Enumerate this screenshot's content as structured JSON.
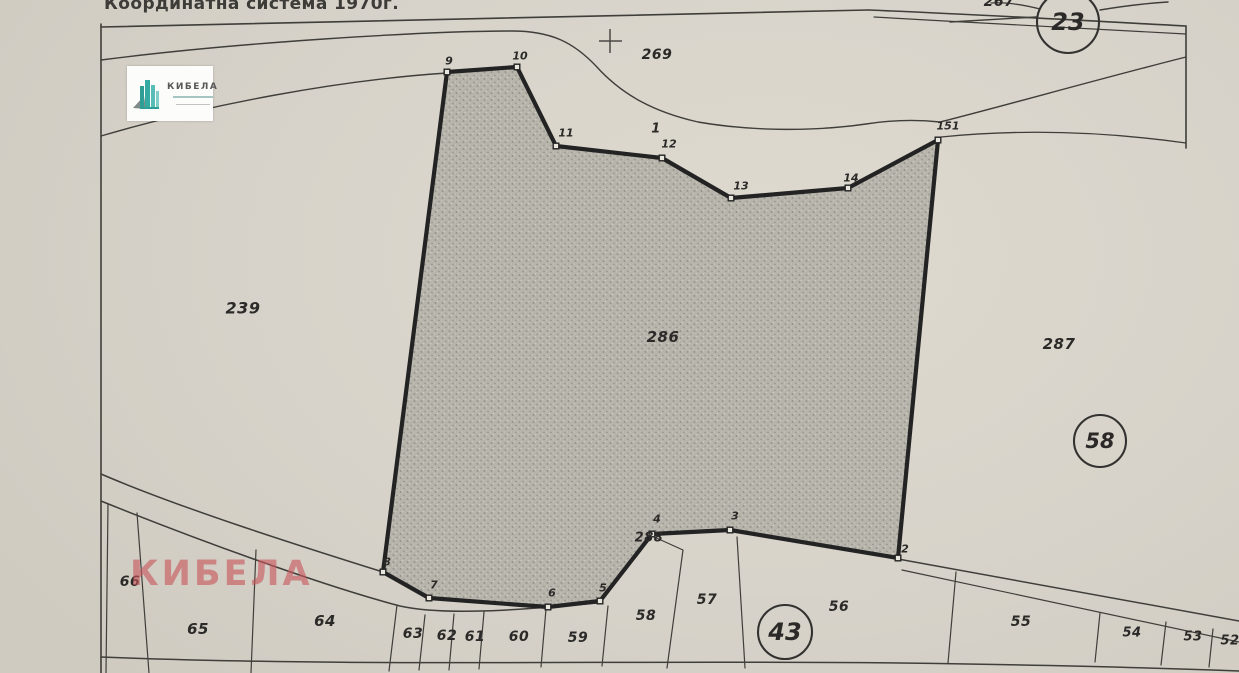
{
  "title": {
    "text": "Координатна система 1970г."
  },
  "logo": {
    "text": "КИБЕЛА"
  },
  "watermark": {
    "text": "КИБЕЛА"
  },
  "map": {
    "colors": {
      "paper": "#d8d4cb",
      "thin_line": "#403e3a",
      "bold_line": "#232323",
      "label": "#2b2a28",
      "vertex_fill": "#e9e6dd",
      "stipple_base": "#b7b4ab",
      "stipple_dark": "#8f8d86",
      "stipple_light": "#cdcac1",
      "circle_stroke": "#333230",
      "watermark_color": "#c9575c",
      "logo_teal": "#35aaa2"
    },
    "main_parcel": {
      "points": [
        [
          447,
          72
        ],
        [
          517,
          67
        ],
        [
          556,
          146
        ],
        [
          662,
          158
        ],
        [
          731,
          198
        ],
        [
          848,
          188
        ],
        [
          938,
          140
        ],
        [
          898,
          558
        ],
        [
          730,
          530
        ],
        [
          652,
          534
        ],
        [
          600,
          601
        ],
        [
          548,
          607
        ],
        [
          429,
          598
        ],
        [
          383,
          572
        ]
      ]
    },
    "vertex_labels": [
      {
        "t": "9",
        "x": 449,
        "y": 61
      },
      {
        "t": "10",
        "x": 520,
        "y": 56
      },
      {
        "t": "11",
        "x": 566,
        "y": 133
      },
      {
        "t": "12",
        "x": 669,
        "y": 144
      },
      {
        "t": "13",
        "x": 741,
        "y": 186
      },
      {
        "t": "14",
        "x": 851,
        "y": 178
      },
      {
        "t": "151",
        "x": 948,
        "y": 126
      },
      {
        "t": "2",
        "x": 905,
        "y": 549
      },
      {
        "t": "3",
        "x": 735,
        "y": 516
      },
      {
        "t": "4",
        "x": 657,
        "y": 519
      },
      {
        "t": "5",
        "x": 603,
        "y": 588
      },
      {
        "t": "6",
        "x": 552,
        "y": 593
      },
      {
        "t": "7",
        "x": 434,
        "y": 585
      },
      {
        "t": "8",
        "x": 387,
        "y": 562
      }
    ],
    "parcel_labels": [
      {
        "t": "239",
        "x": 243,
        "y": 308,
        "s": 16
      },
      {
        "t": "286",
        "x": 663,
        "y": 337,
        "s": 15
      },
      {
        "t": "287",
        "x": 1059,
        "y": 344,
        "s": 15
      },
      {
        "t": "269",
        "x": 657,
        "y": 55,
        "s": 14
      },
      {
        "t": "1",
        "x": 656,
        "y": 129,
        "s": 13
      },
      {
        "t": "288",
        "x": 649,
        "y": 538,
        "s": 13
      },
      {
        "t": "267",
        "x": 999,
        "y": 2,
        "s": 14
      },
      {
        "t": "66",
        "x": 130,
        "y": 582,
        "s": 14
      },
      {
        "t": "65",
        "x": 198,
        "y": 629,
        "s": 15
      },
      {
        "t": "64",
        "x": 325,
        "y": 621,
        "s": 15
      },
      {
        "t": "63",
        "x": 413,
        "y": 634,
        "s": 14
      },
      {
        "t": "62",
        "x": 447,
        "y": 636,
        "s": 14
      },
      {
        "t": "61",
        "x": 475,
        "y": 637,
        "s": 14
      },
      {
        "t": "60",
        "x": 519,
        "y": 637,
        "s": 14
      },
      {
        "t": "59",
        "x": 578,
        "y": 638,
        "s": 14
      },
      {
        "t": "58",
        "x": 646,
        "y": 616,
        "s": 14
      },
      {
        "t": "57",
        "x": 707,
        "y": 600,
        "s": 14
      },
      {
        "t": "56",
        "x": 839,
        "y": 607,
        "s": 14
      },
      {
        "t": "55",
        "x": 1021,
        "y": 622,
        "s": 14
      },
      {
        "t": "54",
        "x": 1132,
        "y": 633,
        "s": 13
      },
      {
        "t": "53",
        "x": 1193,
        "y": 637,
        "s": 13
      },
      {
        "t": "52",
        "x": 1230,
        "y": 641,
        "s": 13
      }
    ],
    "circled_labels": [
      {
        "t": "23",
        "x": 1068,
        "y": 22,
        "r": 31,
        "s": 24
      },
      {
        "t": "58",
        "x": 1100,
        "y": 441,
        "r": 26,
        "s": 21
      },
      {
        "t": "43",
        "x": 785,
        "y": 632,
        "r": 27,
        "s": 24
      }
    ],
    "cross": {
      "x": 610,
      "y": 41
    },
    "lines": [
      {
        "n": "frame-left",
        "d": "M101,24 L101,673",
        "w": 1.6
      },
      {
        "n": "frame-top",
        "d": "M101,27 L868,10",
        "w": 1.6
      },
      {
        "n": "frame-top-right",
        "d": "M868,10 C970,14 1090,21 1186,26",
        "w": 1.6
      },
      {
        "n": "frame-top-right-2",
        "d": "M874,17 C980,23 1090,29 1186,34",
        "w": 1.2
      },
      {
        "n": "frame-right",
        "d": "M1186,26 L1186,148",
        "w": 1.6
      },
      {
        "n": "road-north-edge",
        "d": "M101,60 C240,42 430,31 512,31 C552,31 574,43 596,66 C622,95 654,112 698,122 C756,132 818,131 866,124 C898,119 922,120 940,122",
        "w": 1.4
      },
      {
        "n": "road-northeast-edge",
        "d": "M940,122 C1000,107 1095,80 1186,57",
        "w": 1.4
      },
      {
        "n": "road-south-edge-left",
        "d": "M101,136 C210,104 340,80 447,73",
        "w": 1.4
      },
      {
        "n": "parcel287-north-edge",
        "d": "M941,137 C1020,129 1100,131 1186,143",
        "w": 1.3
      },
      {
        "n": "road-bottomleft-north",
        "d": "M101,474 C180,508 300,546 383,572",
        "w": 1.5
      },
      {
        "n": "road-bottomleft-south",
        "d": "M101,501 C190,537 320,585 400,606 C445,616 520,610 597,603",
        "w": 1.5
      },
      {
        "n": "strip-bottom-line",
        "d": "M101,657 C350,667 620,660 900,663 C1050,665 1160,668 1239,671",
        "w": 1.5
      },
      {
        "n": "road-bottomright-1",
        "d": "M898,559 L1239,621",
        "w": 1.5
      },
      {
        "n": "road-bottomright-2",
        "d": "M902,570 L1239,642",
        "w": 1.2
      },
      {
        "n": "divider-66-left",
        "d": "M108,504 L106,673",
        "w": 1.2
      },
      {
        "n": "divider-66-65",
        "d": "M137,513 L149,673",
        "w": 1.2
      },
      {
        "n": "divider-65-64",
        "d": "M256,550 L251,673",
        "w": 1.2
      },
      {
        "n": "divider-64-63",
        "d": "M397,605 L389,671",
        "w": 1.2
      },
      {
        "n": "divider-63-62",
        "d": "M425,615 L419,670",
        "w": 1.2
      },
      {
        "n": "divider-62-61",
        "d": "M454,614 L449,670",
        "w": 1.2
      },
      {
        "n": "divider-61-60",
        "d": "M484,612 L479,669",
        "w": 1.2
      },
      {
        "n": "divider-60-59",
        "d": "M546,609 L541,667",
        "w": 1.2
      },
      {
        "n": "divider-59-58",
        "d": "M608,606 L602,666",
        "w": 1.2
      },
      {
        "n": "divider-58-57",
        "d": "M652,536 L683,550 L667,668",
        "w": 1.2
      },
      {
        "n": "divider-57-56",
        "d": "M737,537 L745,668",
        "w": 1.2
      },
      {
        "n": "divider-56-55",
        "d": "M956,572 L948,663",
        "w": 1.2
      },
      {
        "n": "divider-55-54",
        "d": "M1100,613 L1095,662",
        "w": 1.2
      },
      {
        "n": "divider-54-53",
        "d": "M1166,622 L1161,665",
        "w": 1.2
      },
      {
        "n": "divider-53-52",
        "d": "M1213,629 L1209,667",
        "w": 1.2
      },
      {
        "n": "circle23-line-left",
        "d": "M950,22 L1036,17",
        "w": 1.4
      },
      {
        "n": "circle23-line-right",
        "d": "M1100,10 C1130,5 1152,3 1168,2",
        "w": 1.4
      },
      {
        "n": "circle23-link-267",
        "d": "M1040,9 C1020,4 1005,2 991,3",
        "w": 1.3
      }
    ]
  }
}
